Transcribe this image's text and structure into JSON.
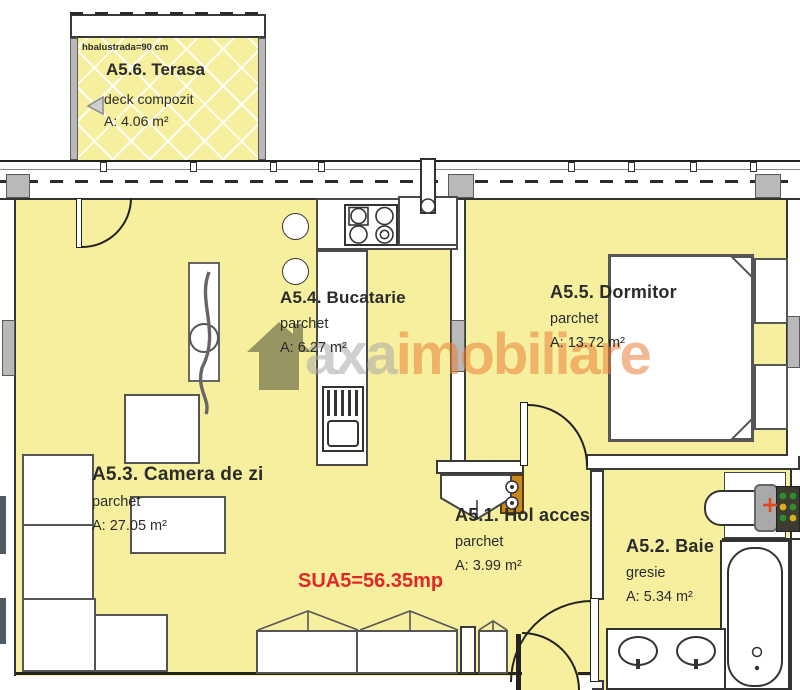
{
  "plan_title": "Apartment A5 floor plan",
  "rooms": [
    {
      "id": "terasa",
      "title": "A5.6. Terasa",
      "finish": "deck compozit",
      "area": "A: 4.06 m²",
      "note": "hbalustrada=90 cm"
    },
    {
      "id": "bucatarie",
      "title": "A5.4. Bucatarie",
      "finish": "parchet",
      "area": "A: 6.27 m²"
    },
    {
      "id": "dormitor",
      "title": "A5.5. Dormitor",
      "finish": "parchet",
      "area": "A: 13.72 m²"
    },
    {
      "id": "camera_de_zi",
      "title": "A5.3. Camera de zi",
      "finish": "parchet",
      "area": "A: 27.05 m²"
    },
    {
      "id": "hol_acces",
      "title": "A5.1. Hol acces",
      "finish": "parchet",
      "area": "A: 3.99 m²"
    },
    {
      "id": "baie",
      "title": "A5.2. Baie",
      "finish": "gresie",
      "area": "A: 5.34 m²"
    }
  ],
  "summary": {
    "label": "SUA5=56.35mp",
    "color": "#e3262a"
  },
  "watermark": {
    "brand_gray": "axa",
    "brand_orange": "imobiliare"
  },
  "colors": {
    "room_fill": "#f6ef9e",
    "wall_gray": "#b9b9b9",
    "line": "#333333",
    "summary_red": "#e3262a",
    "watermark_orange": "#e9803a",
    "watermark_gray": "#a8a8a8",
    "cabinet_orange": "#c8881c"
  }
}
